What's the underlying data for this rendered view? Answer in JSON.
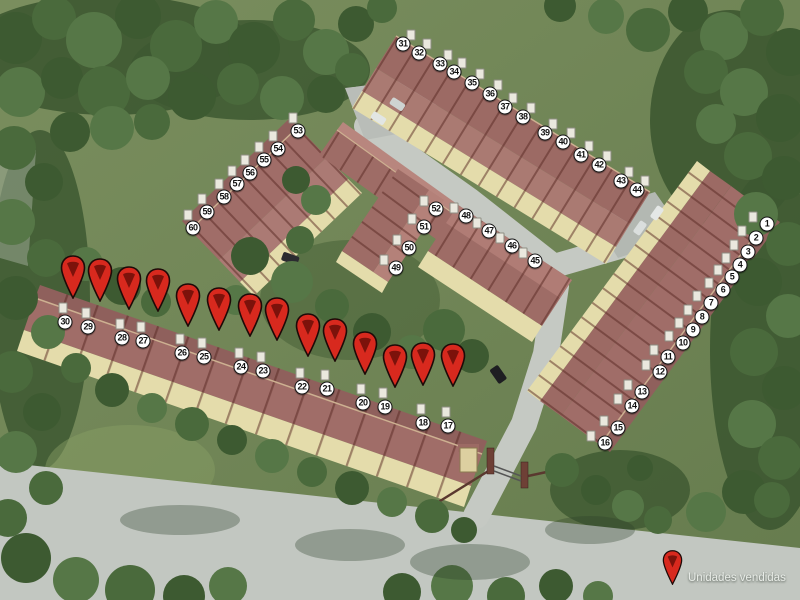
{
  "legend": {
    "label": "Unidades vendidas"
  },
  "palette": {
    "pin_red": "#d8291e",
    "pin_dark": "#7c120b",
    "pin_outline": "#1e0a08",
    "badge_bg": "#ffffff",
    "badge_border": "#161616",
    "badge_text": "#111111",
    "roof": "#a06d68",
    "roof_dark": "#8f605c",
    "roof_light": "#ab7a74",
    "wall": "#e4dcab",
    "road": "#c2c7c1",
    "grass": "#6f8457",
    "tree": "#3d5a31",
    "legend_text": "#e9ede8"
  },
  "sold_pins": [
    {
      "x": 73,
      "y": 255
    },
    {
      "x": 100,
      "y": 258
    },
    {
      "x": 129,
      "y": 266
    },
    {
      "x": 158,
      "y": 268
    },
    {
      "x": 188,
      "y": 283
    },
    {
      "x": 219,
      "y": 287
    },
    {
      "x": 250,
      "y": 293
    },
    {
      "x": 277,
      "y": 297
    },
    {
      "x": 308,
      "y": 313
    },
    {
      "x": 335,
      "y": 318
    },
    {
      "x": 365,
      "y": 331
    },
    {
      "x": 395,
      "y": 344
    },
    {
      "x": 423,
      "y": 342
    },
    {
      "x": 453,
      "y": 343
    }
  ],
  "units": {
    "front_row": {
      "vent_offset": [
        -2,
        -14
      ],
      "list": [
        {
          "n": 30,
          "x": 65,
          "y": 322
        },
        {
          "n": 29,
          "x": 88,
          "y": 327
        },
        {
          "n": 28,
          "x": 122,
          "y": 338
        },
        {
          "n": 27,
          "x": 143,
          "y": 341
        },
        {
          "n": 26,
          "x": 182,
          "y": 353
        },
        {
          "n": 25,
          "x": 204,
          "y": 357
        },
        {
          "n": 24,
          "x": 241,
          "y": 367
        },
        {
          "n": 23,
          "x": 263,
          "y": 371
        },
        {
          "n": 22,
          "x": 302,
          "y": 387
        },
        {
          "n": 21,
          "x": 327,
          "y": 389
        },
        {
          "n": 20,
          "x": 363,
          "y": 403
        },
        {
          "n": 19,
          "x": 385,
          "y": 407
        },
        {
          "n": 18,
          "x": 423,
          "y": 423
        },
        {
          "n": 17,
          "x": 448,
          "y": 426
        }
      ]
    },
    "top_right_block": {
      "vent_offset": [
        8,
        -9
      ],
      "list": [
        {
          "n": 31,
          "x": 403,
          "y": 44
        },
        {
          "n": 32,
          "x": 419,
          "y": 53
        },
        {
          "n": 33,
          "x": 440,
          "y": 64
        },
        {
          "n": 34,
          "x": 454,
          "y": 72
        },
        {
          "n": 35,
          "x": 472,
          "y": 83
        },
        {
          "n": 36,
          "x": 490,
          "y": 94
        },
        {
          "n": 37,
          "x": 505,
          "y": 107
        },
        {
          "n": 38,
          "x": 523,
          "y": 117
        },
        {
          "n": 39,
          "x": 545,
          "y": 133
        },
        {
          "n": 40,
          "x": 563,
          "y": 142
        },
        {
          "n": 41,
          "x": 581,
          "y": 155
        },
        {
          "n": 42,
          "x": 599,
          "y": 165
        },
        {
          "n": 43,
          "x": 621,
          "y": 181
        },
        {
          "n": 44,
          "x": 637,
          "y": 190
        }
      ]
    },
    "right_block": {
      "vent_offset": [
        -14,
        -7
      ],
      "list": [
        {
          "n": 1,
          "x": 767,
          "y": 224
        },
        {
          "n": 2,
          "x": 756,
          "y": 238
        },
        {
          "n": 3,
          "x": 748,
          "y": 252
        },
        {
          "n": 4,
          "x": 740,
          "y": 265
        },
        {
          "n": 5,
          "x": 732,
          "y": 277
        },
        {
          "n": 6,
          "x": 723,
          "y": 290
        },
        {
          "n": 7,
          "x": 711,
          "y": 303
        },
        {
          "n": 8,
          "x": 702,
          "y": 317
        },
        {
          "n": 9,
          "x": 693,
          "y": 330
        },
        {
          "n": 10,
          "x": 683,
          "y": 343
        },
        {
          "n": 11,
          "x": 668,
          "y": 357
        },
        {
          "n": 12,
          "x": 660,
          "y": 372
        },
        {
          "n": 13,
          "x": 642,
          "y": 392
        },
        {
          "n": 14,
          "x": 632,
          "y": 406
        },
        {
          "n": 15,
          "x": 618,
          "y": 428
        },
        {
          "n": 16,
          "x": 605,
          "y": 443
        }
      ]
    },
    "left_block": {
      "vent_offset": [
        -5,
        -13
      ],
      "list": [
        {
          "n": 53,
          "x": 298,
          "y": 131
        },
        {
          "n": 54,
          "x": 278,
          "y": 149
        },
        {
          "n": 55,
          "x": 264,
          "y": 160
        },
        {
          "n": 56,
          "x": 250,
          "y": 173
        },
        {
          "n": 57,
          "x": 237,
          "y": 184
        },
        {
          "n": 58,
          "x": 224,
          "y": 197
        },
        {
          "n": 59,
          "x": 207,
          "y": 212
        },
        {
          "n": 60,
          "x": 193,
          "y": 228
        }
      ]
    },
    "middle_block": {
      "vent_offset": [
        -12,
        -8
      ],
      "list": [
        {
          "n": 52,
          "x": 436,
          "y": 209
        },
        {
          "n": 51,
          "x": 424,
          "y": 227
        },
        {
          "n": 50,
          "x": 409,
          "y": 248
        },
        {
          "n": 49,
          "x": 396,
          "y": 268
        },
        {
          "n": 48,
          "x": 466,
          "y": 216
        },
        {
          "n": 47,
          "x": 489,
          "y": 231
        },
        {
          "n": 46,
          "x": 512,
          "y": 246
        },
        {
          "n": 45,
          "x": 535,
          "y": 261
        }
      ]
    }
  }
}
